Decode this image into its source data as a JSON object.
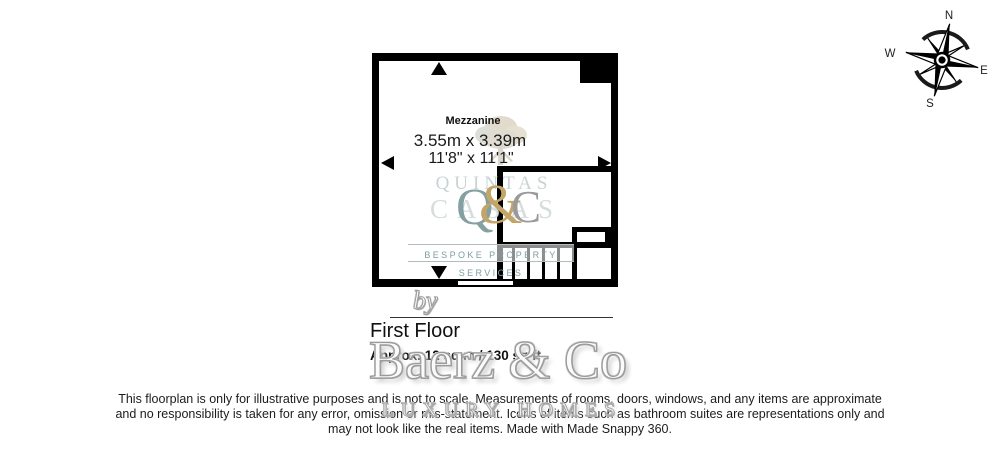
{
  "compass": {
    "north": "N",
    "east": "E",
    "south": "S",
    "west": "W"
  },
  "plan": {
    "room": {
      "name": "Mezzanine",
      "size_metric": "3.55m x 3.39m",
      "size_imperial": "11'8\" x 11'1\""
    }
  },
  "watermark": {
    "ghost_top": "QUINTAS",
    "ghost_mid": "CASAS",
    "monogram_q": "Q",
    "monogram_amp": "&",
    "monogram_c": "C",
    "tagline": "BESPOKE PROPERTY SERVICES",
    "by": "by",
    "brand": "Baerz & Co",
    "brand_tagline": "LUXURY HOMES"
  },
  "floor": {
    "title": "First Floor",
    "area": "Approx. 12 sq m / 130 sq ft"
  },
  "disclaimer": {
    "line1": "This floorplan is only for illustrative purposes and is not to scale. Measurements of rooms, doors, windows, and any items are approximate",
    "line2": "and no responsibility is taken for any error, omission or mis-statement. Icons of items such as bathroom suites are representations only and",
    "line3": "may not look like the real items. Made with Made Snappy 360."
  },
  "colors": {
    "wall": "#000000",
    "quintas_teal": "#7e9d9f",
    "quintas_gold": "#c2a567",
    "watermark_gray": "#9a9a9a"
  }
}
